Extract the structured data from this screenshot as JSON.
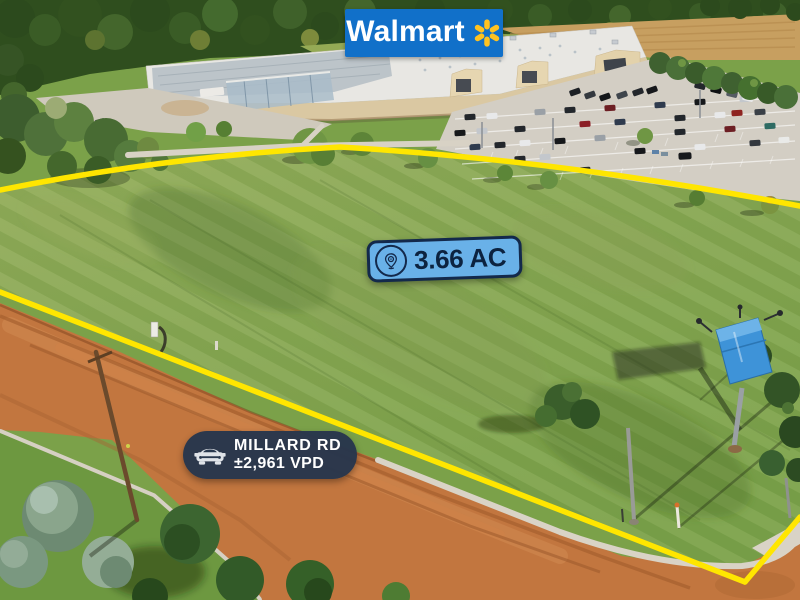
{
  "scene": {
    "type": "aerial-drone-photo",
    "landmarks": [
      "forest treeline",
      "farm field",
      "Walmart supercenter building",
      "customer parking lot",
      "vacant grass parcel outlined in yellow",
      "Millard Rd dirt road",
      "blue billboard sign"
    ]
  },
  "badges": {
    "brand": {
      "label": "Walmart",
      "icon": "walmart-spark-icon",
      "bg_color": "#1170c9",
      "text_color": "#ffffff",
      "spark_color": "#ffc220"
    },
    "acreage": {
      "label": "3.66 AC",
      "icon": "location-pin-icon",
      "bg_color": "#69b1e8",
      "border_color": "#13294b",
      "text_color": "#0c2340"
    },
    "road": {
      "name": "MILLARD RD",
      "traffic": "±2,961 VPD",
      "icon": "car-front-icon",
      "bg_color": "#28374d",
      "text_color": "#ffffff"
    }
  },
  "boundary": {
    "color": "#ffe600",
    "style": "solid polygon outline around parcel"
  }
}
